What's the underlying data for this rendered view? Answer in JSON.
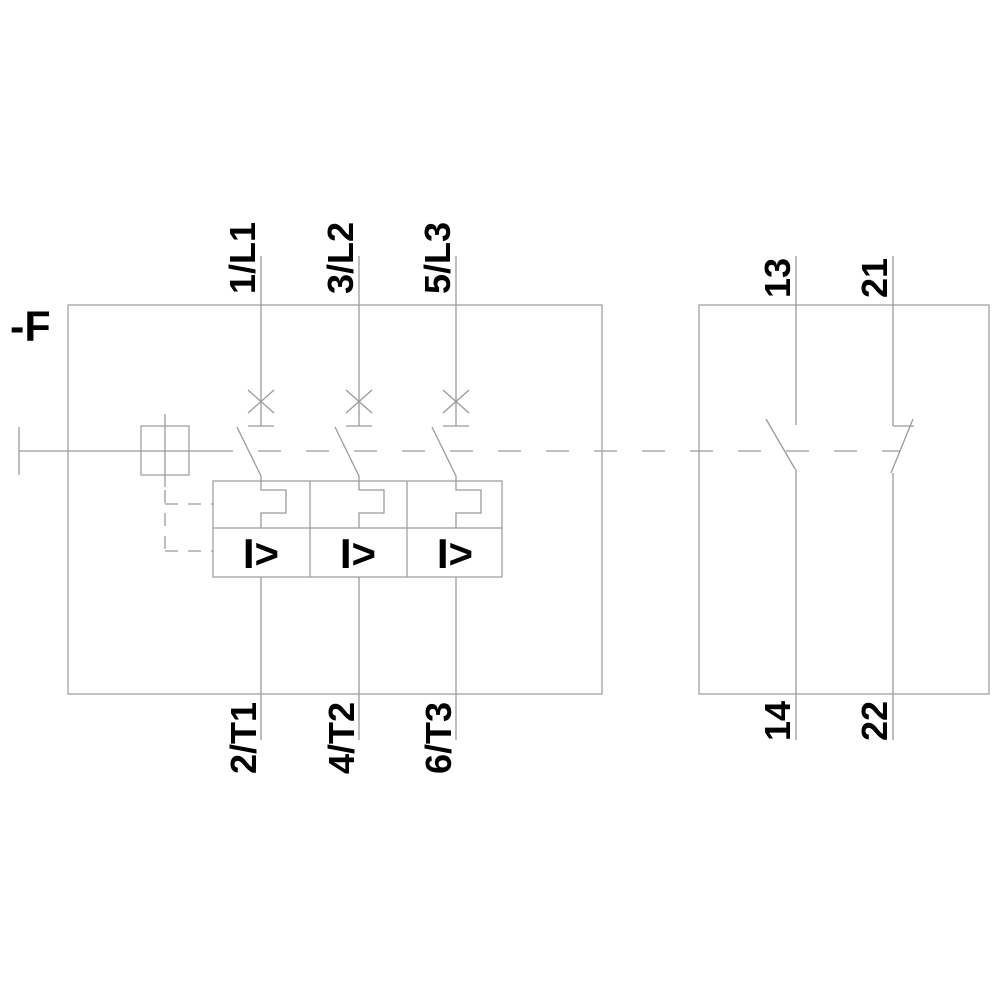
{
  "diagram": {
    "kind": "motor-starter-protector-schematic",
    "device_label": "-F",
    "main_poles": [
      {
        "top_terminal": "1/L1",
        "bottom_terminal": "2/T1"
      },
      {
        "top_terminal": "3/L2",
        "bottom_terminal": "4/T2"
      },
      {
        "top_terminal": "5/L3",
        "bottom_terminal": "6/T3"
      }
    ],
    "aux_contacts": [
      {
        "top_terminal": "13",
        "bottom_terminal": "14"
      },
      {
        "top_terminal": "21",
        "bottom_terminal": "22"
      }
    ],
    "trip_units": {
      "magnetic_trip_labels": [
        "I>",
        "I>",
        "I>"
      ]
    },
    "colors": {
      "line": "#9a9a9a",
      "text": "#000000",
      "background": "#ffffff"
    }
  }
}
